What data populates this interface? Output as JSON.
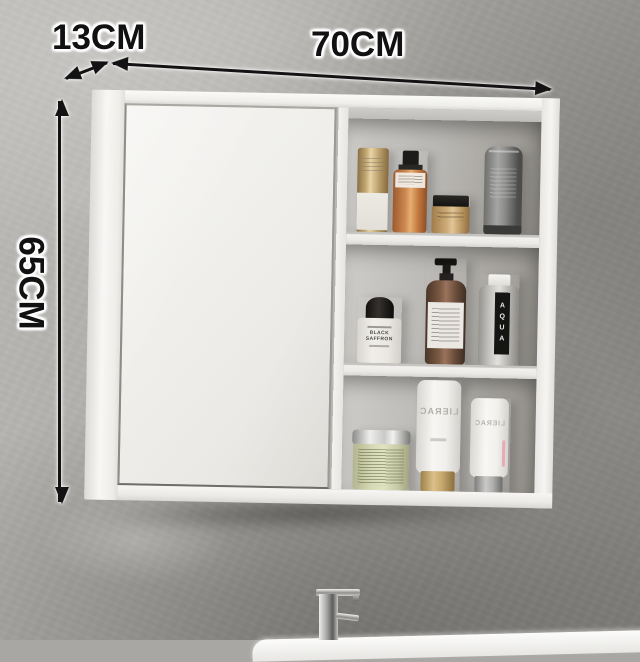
{
  "annotations": {
    "width_label": "70CM",
    "depth_label": "13CM",
    "height_label": "65CM"
  },
  "cabinet": {
    "name": "white wall-mounted mirror cabinet",
    "sections": [
      "mirror door",
      "open shelves"
    ]
  },
  "products": {
    "top_shelf": [
      {
        "name": "gold pump bottle"
      },
      {
        "name": "orange spray bottle with black nozzle"
      },
      {
        "name": "tan cream jar with black lid"
      },
      {
        "name": "gray cosmetic tube"
      }
    ],
    "middle_shelf": [
      {
        "name": "perfume bottle with black cap",
        "label": "BLACK SAFFRON"
      },
      {
        "name": "amber glass pump dispenser"
      },
      {
        "name": "clear water bottle",
        "label": "AQUA"
      }
    ],
    "bottom_shelf": [
      {
        "name": "green jar with chrome lid"
      },
      {
        "name": "white tube on gold cap",
        "label": "LIERAC"
      },
      {
        "name": "white tube on silver cap",
        "label": "LIERAC"
      }
    ]
  },
  "fixtures": {
    "faucet": "chrome single-lever faucet",
    "sink": "white basin rim"
  },
  "colors": {
    "wall_light": "#bcbab6",
    "wall_dark": "#8b8a86",
    "cabinet_white": "#f2f1ee",
    "annotation_text": "#111111",
    "annotation_halo": "#ffffff",
    "gold": "#c3a874",
    "orange": "#cf8a52",
    "amber_glass": "#7b5a43",
    "green_jar": "#d7dab6",
    "pink_accent": "#e9aab4",
    "chrome": "#c9c9c7"
  }
}
